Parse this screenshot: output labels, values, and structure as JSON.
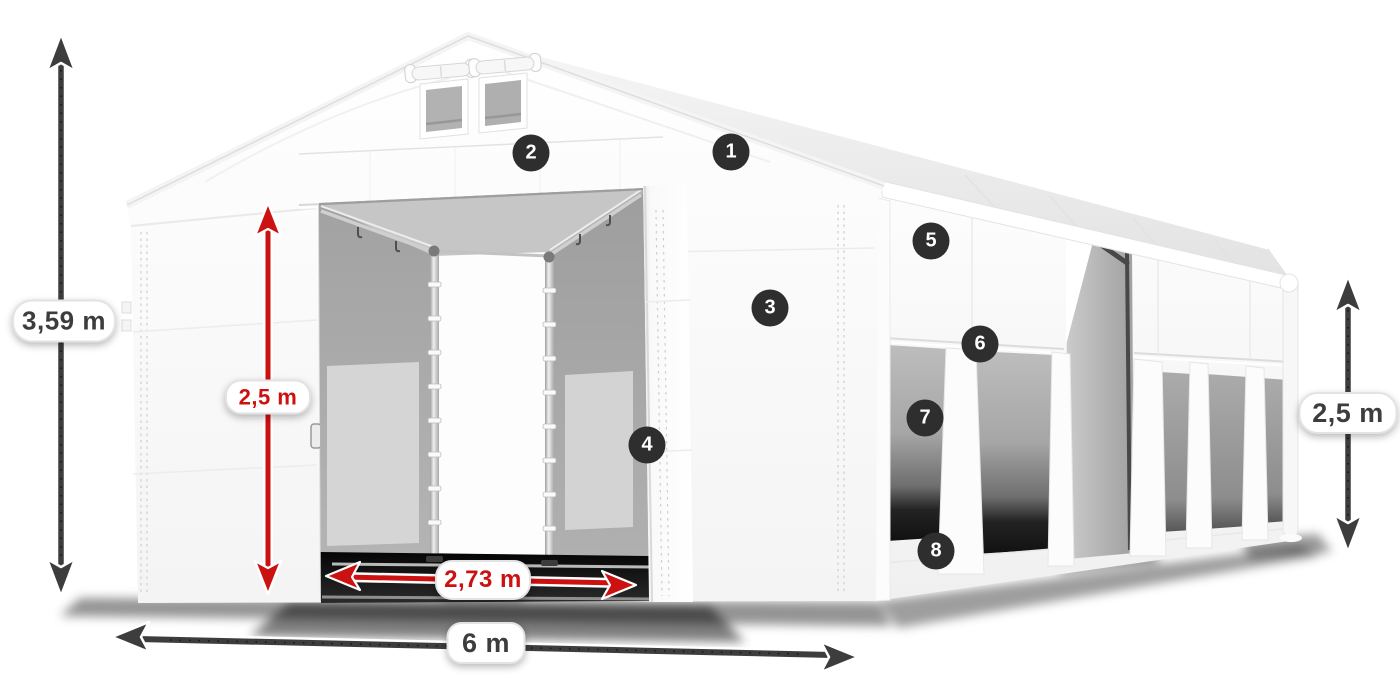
{
  "page": {
    "background_color": "#ffffff"
  },
  "product_diagram": {
    "subject": "White PVC storage tent, 3D render with open front entrance, windowed side wall and roof vents",
    "view": "front-left perspective"
  },
  "dimensions": {
    "total_height": {
      "label": "3,59 m",
      "color_style": "dark"
    },
    "entrance_height": {
      "label": "2,5 m",
      "color_style": "red"
    },
    "entrance_width": {
      "label": "2,73 m",
      "color_style": "red"
    },
    "tent_width": {
      "label": "6 m",
      "color_style": "dark"
    },
    "side_wall_height": {
      "label": "2,5 m",
      "color_style": "dark"
    }
  },
  "callouts": [
    {
      "number": "1"
    },
    {
      "number": "2"
    },
    {
      "number": "3"
    },
    {
      "number": "4"
    },
    {
      "number": "5"
    },
    {
      "number": "6"
    },
    {
      "number": "7"
    },
    {
      "number": "8"
    }
  ],
  "colors": {
    "dimension_dark": "#3d3d3d",
    "dimension_red": "#cc1111",
    "badge_background": "#2e2e2e",
    "badge_text": "#ffffff",
    "pill_background": "#ffffff",
    "pill_border": "#e3e3e3"
  }
}
